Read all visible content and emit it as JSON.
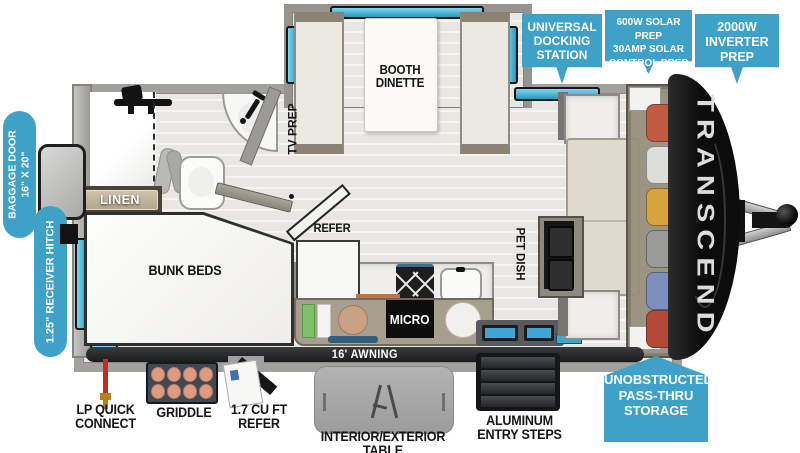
{
  "brand": {
    "name": "TRANSCEND"
  },
  "top_callouts": {
    "docking": {
      "line1": "UNIVERSAL",
      "line2": "DOCKING",
      "line3": "STATION"
    },
    "solar": {
      "line1": "600W SOLAR PREP",
      "line2": "30AMP SOLAR",
      "line3": "CONTROL PREP"
    },
    "inverter": {
      "line1": "2000W",
      "line2": "INVERTER",
      "line3": "PREP"
    }
  },
  "side_callouts": {
    "baggage_door": {
      "line1": "BAGGAGE DOOR",
      "line2": "16\" X 20\""
    },
    "receiver_hitch": {
      "label": "1.25\" RECEIVER HITCH"
    }
  },
  "bottom_callouts": {
    "passthru": {
      "line1": "UNOBSTRUCTED",
      "line2": "PASS-THRU",
      "line3": "STORAGE"
    }
  },
  "interior_labels": {
    "booth_dinette_line1": "BOOTH",
    "booth_dinette_line2": "DINETTE",
    "tv_prep": "TV PREP",
    "linen": "LINEN",
    "bunk_beds": "BUNK BEDS",
    "refer": "REFER",
    "pet_dish": "PET DISH",
    "micro": "MICRO",
    "awning": "16' AWNING"
  },
  "exterior_features": {
    "lp": {
      "line1": "LP QUICK",
      "line2": "CONNECT"
    },
    "griddle": {
      "label": "GRIDDLE"
    },
    "mini_refer": {
      "line1": "1.7 CU FT",
      "line2": "REFER"
    },
    "table": {
      "label": "INTERIOR/EXTERIOR TABLE"
    },
    "steps": {
      "line1": "ALUMINUM",
      "line2": "ENTRY STEPS"
    }
  },
  "icons": {
    "shower_head": "css-shape",
    "sink_faucet": "css-shape",
    "stove_burners": "css-x-shape",
    "table_folding_leg": "css-shape",
    "lp_hose": "css-shape"
  },
  "colors": {
    "callout_blue": "#3EA2C8",
    "window_blue": "#56C4EA",
    "wall_gray": "#A3A19E",
    "cap_black": "#141414",
    "cabinet_tan": "#A79E8D"
  }
}
